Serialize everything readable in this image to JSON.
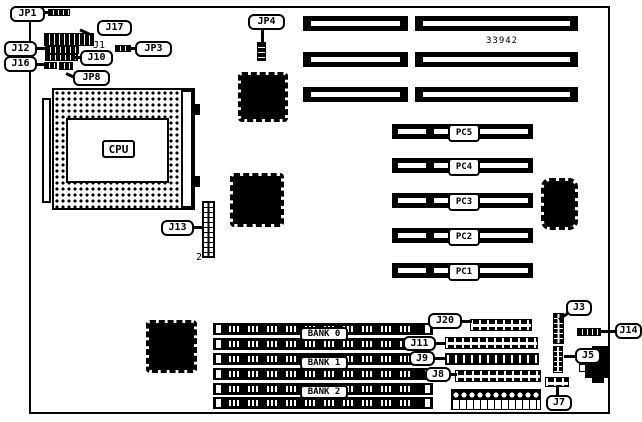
{
  "figure": {
    "part_number": "33942",
    "cpu_label": "CPU",
    "j1_text": "J1",
    "j13_pin_text": "2"
  },
  "callouts": {
    "jp1": "JP1",
    "j17": "J17",
    "j12": "J12",
    "jp3": "JP3",
    "j10": "J10",
    "j16": "J16",
    "jp8": "JP8",
    "jp4": "JP4",
    "j13": "J13",
    "j20": "J20",
    "j11": "J11",
    "j9": "J9",
    "j8": "J8",
    "j3": "J3",
    "j14": "J14",
    "j5": "J5",
    "j7": "J7"
  },
  "pci_slots": {
    "labels": [
      "PC5",
      "PC4",
      "PC3",
      "PC2",
      "PC1"
    ]
  },
  "memory": {
    "banks": [
      "BANK 0",
      "BANK 1",
      "BANK 2"
    ]
  }
}
